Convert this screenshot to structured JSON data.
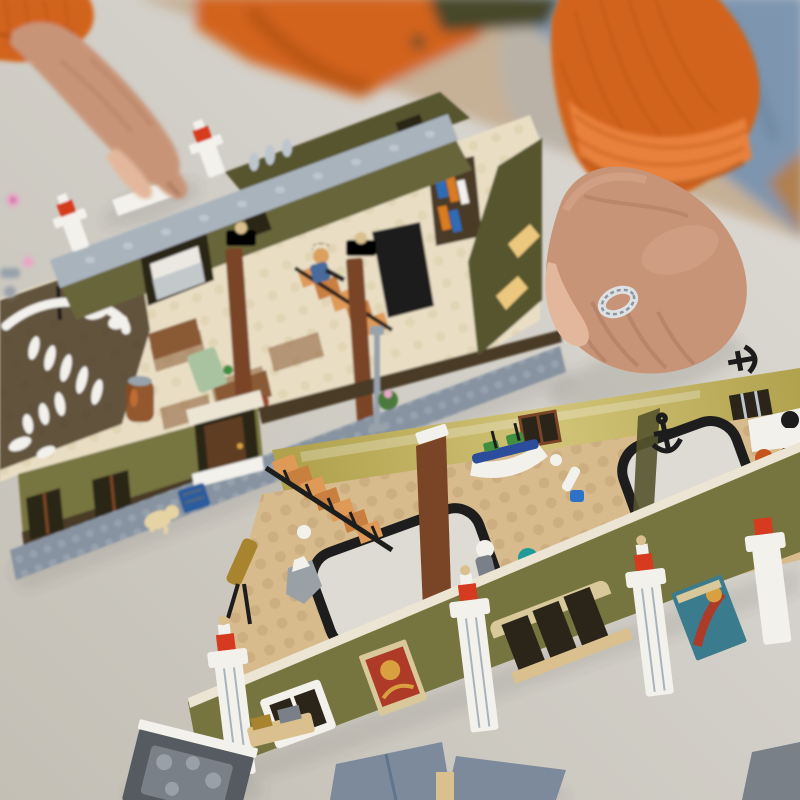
{
  "scene": {
    "type": "photograph",
    "description": "Overhead close-up photo of a person in an orange corduroy shirt and jeans assembling a large LEGO modular museum building on a light grey table. The olive-green roof/top-floor section (with bedroom, kitchen, hanging whale skeleton, staircase minifigure, sidewalk with dog, blue crate and lamppost) sits at the upper left. The ground-floor section (with grand staircase, brass telescope, orrery with colored planets, boat model, anchors, statue, child minifigures, posters and white columns topped with red tiles) sits at the lower right. The left hand reaches in to place a piece; the right hand, wearing a braided silver ring, rests on the table. Loose grey plates and a pink flower piece lie on the table.",
    "person": {
      "clothing": [
        "orange corduroy shirt with rolled cuffs",
        "dark olive undershirt collar",
        "blue denim jeans"
      ],
      "jewelry": "braided silver ring on right ring finger",
      "pose": "left hand placing a white tile on the roof cornice; right hand resting flat on table"
    },
    "objects": [
      "upper-building-section",
      "lower-building-section",
      "whale-skeleton",
      "bedroom-window-with-bed",
      "kitchen-interior",
      "bookshelf",
      "black-desk",
      "interior-staircase-minifigure",
      "amber-jar",
      "roof-cornice",
      "red-tile-corner-posts",
      "brown-support-pillars",
      "front-door-with-awning",
      "sidewalk-baseplate",
      "dog-figure",
      "blue-crate",
      "lamppost",
      "flower-plant",
      "grand-staircase",
      "brass-telescope",
      "rock-specimen",
      "orrery-with-planets",
      "statue-figure",
      "rubber-duck",
      "boat-model",
      "small-telescope",
      "anchor-decorations",
      "atrium-floor-openings",
      "kid-minifigure-pink",
      "minifigure-white-top",
      "museum-posters",
      "white-columns-red-tiles",
      "arched-windows",
      "loose-grey-plates",
      "pink-flower-piece"
    ]
  },
  "palette": {
    "bg_floor": "#c6b096",
    "cardboard": "#b08050",
    "denim": "#7d95af",
    "denim_dark": "#4e6680",
    "denim_light": "#a4b6c8",
    "shirt": "#d2641c",
    "shirt_dark": "#9e430f",
    "shirt_light": "#e8813a",
    "shirt_stripe": "#b5500f",
    "collar_olive": "#46472b",
    "skin": "#c89478",
    "skin_shadow": "#9b6a50",
    "skin_dark": "#7f4f3a",
    "skin_light": "#e3b79b",
    "ring_silver": "#dde1e4",
    "ring_shadow": "#8f979e",
    "table": "#d2cfc8",
    "table_dark": "#c3bfb5",
    "table_light": "#dedbd5",
    "shadow": "#4a463e",
    "cornice": "#a9b3bc",
    "cornice_stud": "#bdc6ce",
    "sidewalk": "#8793a0",
    "sidewalk_stud": "#9aa5b0",
    "wall_olive": "#77753f",
    "wall_olive_mid": "#68653a",
    "wall_olive_dark": "#56542e",
    "wall_gloss": "#b1a24e",
    "wall_gloss_light": "#d2c477",
    "wall_brown": "#4a3a26",
    "divider_brown": "#7a4526",
    "dark_opening": "#2b2519",
    "window_glow": "#ecc87e",
    "floor_cream": "#e9dec4",
    "cream_stud": "#d9cba7",
    "floor_tan": "#d8bb8d",
    "tan_stud": "#c4a476",
    "stairs_a": "#e09a58",
    "stairs_b": "#c97f3f",
    "black": "#1d1d1d",
    "white": "#f3f1ec",
    "red_tile": "#d63a1f",
    "bed_white": "#eae8e1",
    "mint": "#a9c3a0",
    "wood_brown": "#8a5a34",
    "amber": "#8a4a1e",
    "terracotta": "#9a4a2a",
    "book_blue": "#2e6cb5",
    "book_orange": "#d97c22",
    "boat_blue": "#2c4d9b",
    "boat_green": "#3f8f3f",
    "teal_planet": "#1f9a9a",
    "magenta": "#bf3a8a",
    "yellow": "#e6c11f",
    "orange_ring": "#d97a20",
    "poster_tan": "#d9c89a",
    "poster_red": "#ae3a28",
    "poster_gold": "#d9a040",
    "poster_teal": "#3a7b8d",
    "anchor": "#1c1c1c",
    "gold": "#a8842e",
    "rock": "#9aa1a6",
    "dog": "#e6d3a4",
    "crate_blue": "#2b5c9e",
    "door": "#5f3c22",
    "awning": "#ece5d4",
    "lamppost": "#98a2aa",
    "hair_brown": "#5a3a1e",
    "hair_orange": "#c4541c",
    "face": "#d9a05e",
    "pink": "#eab6c4",
    "fig_blue": "#4a6a9a",
    "chair_blue": "#2e72c8",
    "green": "#3f8f3f",
    "plate_grey": "#7d8a9c",
    "piece_dark": "#565b61",
    "piece_mid": "#7a8088",
    "piece_stud": "#9aa0a8",
    "piece_tan": "#d9c08e",
    "flower_pink": "#e8a8c8",
    "plant_green": "#4a7a3a"
  }
}
